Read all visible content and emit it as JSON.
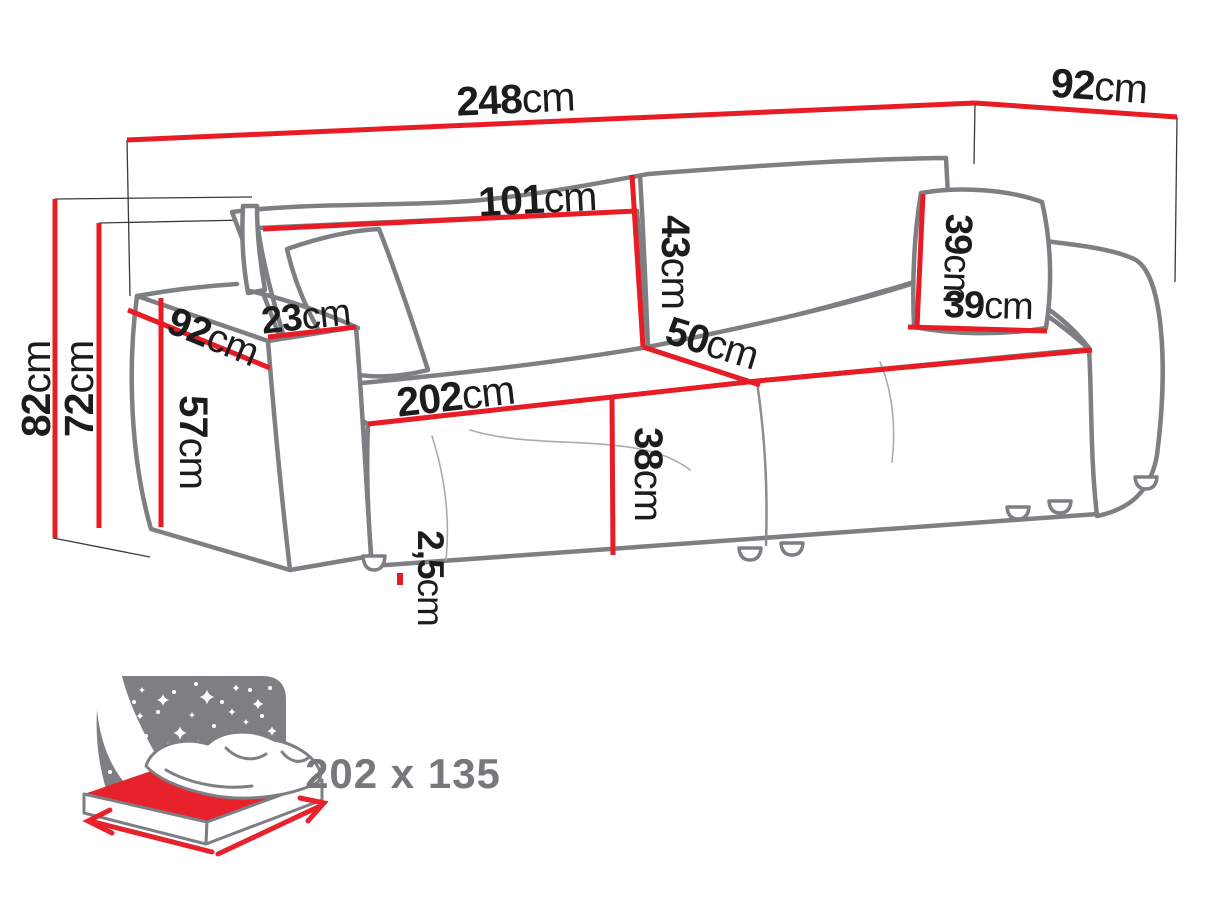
{
  "diagram_type": "sofa-dimensions-diagram",
  "colors": {
    "dimension_red": "#e81c24",
    "sofa_outline_gray": "#7d7f83",
    "light_line_gray": "#a9abad",
    "label_black": "#1c1c1c",
    "icon_gray": "#7d7f82",
    "icon_text_gray": "#77787b"
  },
  "dimensions": {
    "overall_width": {
      "value": "248",
      "unit": "cm"
    },
    "overall_depth": {
      "value": "92",
      "unit": "cm"
    },
    "overall_height": {
      "value": "82",
      "unit": "cm"
    },
    "backrest_height": {
      "value": "72",
      "unit": "cm"
    },
    "armrest_height": {
      "value": "57",
      "unit": "cm"
    },
    "armrest_depth": {
      "value": "92",
      "unit": "cm"
    },
    "armrest_width": {
      "value": "23",
      "unit": "cm"
    },
    "backrest_cushion_width": {
      "value": "101",
      "unit": "cm"
    },
    "backrest_cushion_height": {
      "value": "43",
      "unit": "cm"
    },
    "seat_width": {
      "value": "202",
      "unit": "cm"
    },
    "seat_depth": {
      "value": "50",
      "unit": "cm"
    },
    "seat_height": {
      "value": "38",
      "unit": "cm"
    },
    "leg_height": {
      "value": "2,5",
      "unit": "cm"
    },
    "pillow_height": {
      "value": "39",
      "unit": "cm"
    },
    "pillow_width": {
      "value": "39",
      "unit": "cm"
    }
  },
  "sleeping_area": {
    "size_label": "202 x 135"
  }
}
